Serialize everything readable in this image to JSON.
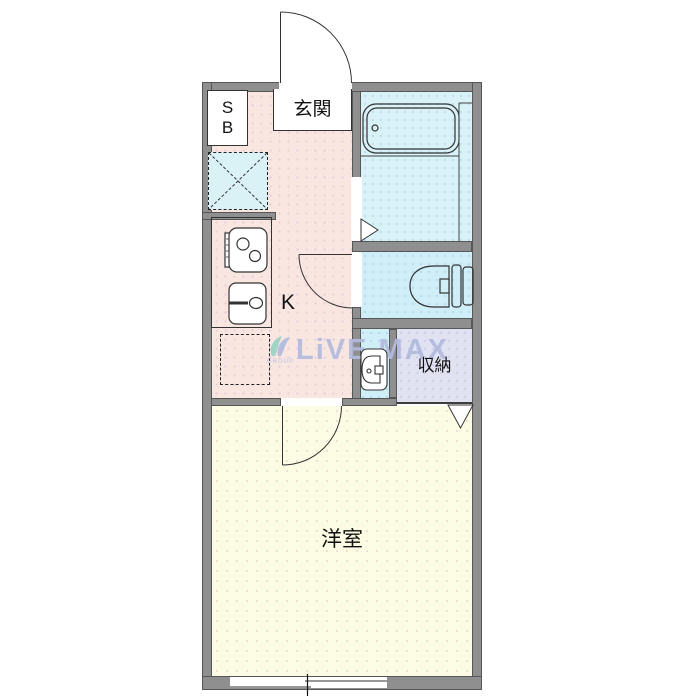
{
  "floorplan": {
    "type": "apartment-floor-plan-1K",
    "labels": {
      "shoe_box": [
        "S",
        "B"
      ],
      "entrance": "玄関",
      "kitchen": "K",
      "storage": "収納",
      "western_room": "洋室"
    },
    "watermark": {
      "text": "LiVE MAX",
      "subtext": "GROUP"
    },
    "colors": {
      "wall": "#8f8f8f",
      "kitchen_floor": "#f9e6e1",
      "bath_floor": "#d8f2f8",
      "toilet_floor": "#cfeef8",
      "washbasin_floor": "#cfeef8",
      "storage_floor": "#e1e2f1",
      "western_room_floor": "#fcfce4",
      "laundry_pan": "#daf1f6",
      "watermark": "#b2bade",
      "watermark_logo_green": "#8fcfc0",
      "watermark_logo_blue": "#a9b6de"
    },
    "rooms": [
      {
        "key": "entrance",
        "label": "玄関"
      },
      {
        "key": "kitchen",
        "label": "K"
      },
      {
        "key": "bathroom",
        "label": ""
      },
      {
        "key": "toilet",
        "label": ""
      },
      {
        "key": "washbasin",
        "label": ""
      },
      {
        "key": "storage",
        "label": "収納"
      },
      {
        "key": "western_room",
        "label": "洋室"
      }
    ],
    "fixtures": [
      "entrance-door",
      "shoe-box",
      "bathtub",
      "bath-door-triangle",
      "toilet",
      "toilet-door",
      "gas-stove",
      "kitchen-sink",
      "laundry-pan",
      "washing-machine-space",
      "washbasin",
      "room-door",
      "closet-door-triangle",
      "sliding-window"
    ]
  }
}
